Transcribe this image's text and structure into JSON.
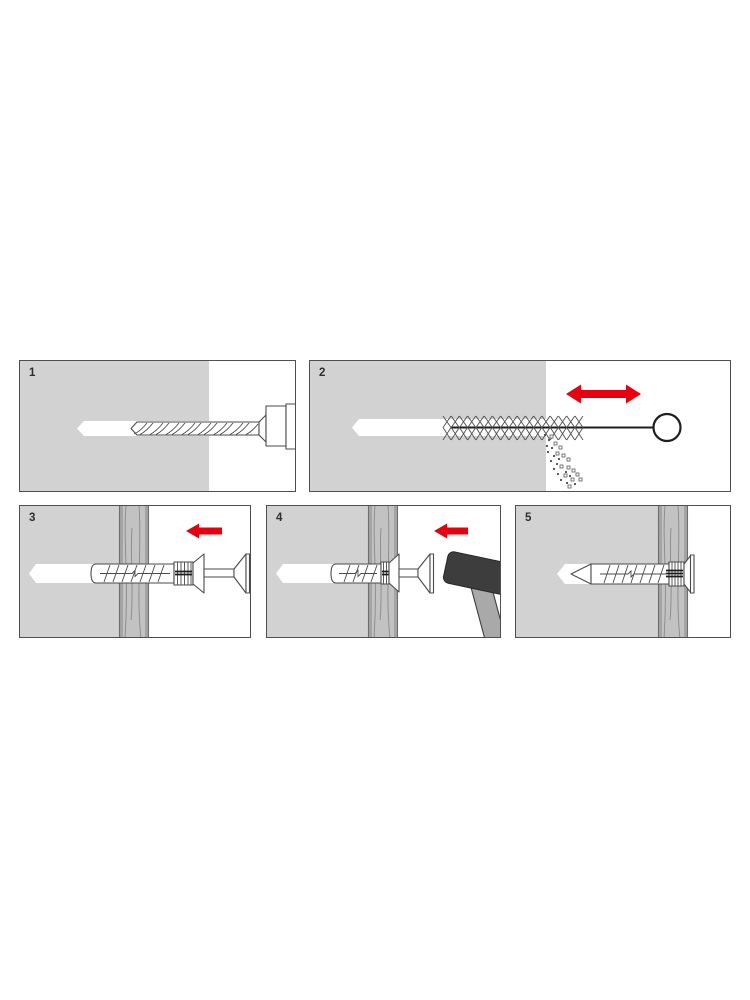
{
  "colors": {
    "wall": "#d2d2d2",
    "board": "#c2c2c2",
    "board_edge": "#a4a4a4",
    "grain": "#8a8a8a",
    "outline": "#4a4a4a",
    "arrow_red": "#e8000f",
    "hammer_head": "#3d3d3d",
    "hammer_handle": "#a9a9a9",
    "label": "#2e2e2e",
    "border": "#4f4f4f"
  },
  "panels": [
    {
      "label": "1",
      "graphic": "drill-bit-icon"
    },
    {
      "label": "2",
      "graphic": "cleaning-brush-icon",
      "arrow": "left-right-arrow-icon"
    },
    {
      "label": "3",
      "graphic": "nail-anchor-icon",
      "arrow": "left-arrow-icon"
    },
    {
      "label": "4",
      "graphic": "hammer-icon",
      "arrow": "left-arrow-icon"
    },
    {
      "label": "5",
      "graphic": "installed-anchor-icon"
    }
  ]
}
